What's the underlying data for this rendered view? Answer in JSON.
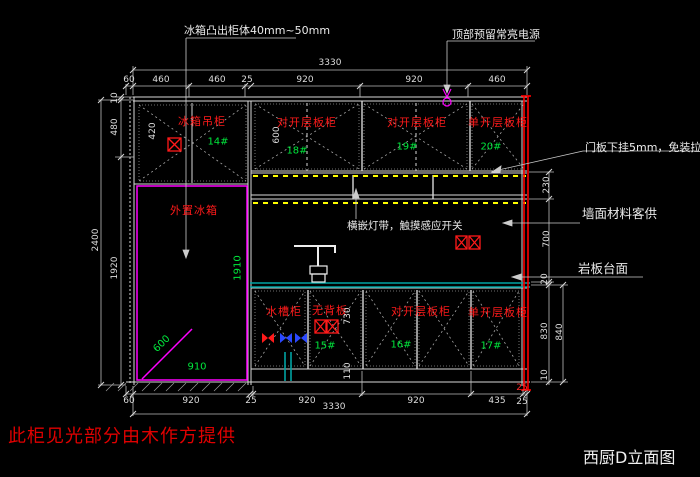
{
  "drawing": {
    "title": "西厨D立面图",
    "bottom_note": "此柜见光部分由木作方提供"
  },
  "annotations": {
    "fridge_protrusion": "冰箱凸出柜体40mm~50mm",
    "top_power": "顶部预留常亮电源",
    "door_gap": "门板下挂5mm，免装拉手",
    "wall_material": "墙面材料客供",
    "countertop": "岩板台面",
    "light_strip": "横嵌灯带，触摸感应开关"
  },
  "labels": {
    "fridge_cabinet": "冰箱吊柜",
    "fridge_cabinet_no": "14#",
    "upper_double_1": "对开层板柜",
    "upper_double_1_no": "18#",
    "upper_double_2": "对开层板柜",
    "upper_double_2_no": "19#",
    "upper_single": "单开层板柜",
    "upper_single_no": "20#",
    "sink_cabinet": "水槽柜",
    "no_back_panel": "无背板",
    "no_back_panel_no": "15#",
    "base_double": "对开层板柜",
    "base_double_no": "16#",
    "base_single": "单开层板柜",
    "base_single_no": "17#",
    "external_fridge": "外置冰箱"
  },
  "dims": {
    "top_total": "3330",
    "top_chain": [
      "60",
      "460",
      "460",
      "25",
      "920",
      "920",
      "460"
    ],
    "bottom_chain": [
      "60",
      "920",
      "25",
      "920",
      "920",
      "435"
    ],
    "bottom_wall": "25",
    "bottom_wall_red": "25",
    "bottom_total": "3330",
    "left_total": "2400",
    "left_chain": [
      "10",
      "480",
      "1920"
    ],
    "right_chain": [
      "230",
      "700",
      "20",
      "830",
      "10"
    ],
    "right_total": "840",
    "fridge_w": "910",
    "fridge_h": "1910",
    "fridge_diag": "600",
    "upper_h": "600",
    "fridge_cab_h": "420",
    "base_door_h": "730",
    "toe_kick": "110"
  },
  "colors": {
    "line": "#e0e0e0",
    "label_red": "#ff1a1a",
    "number_green": "#00e83c",
    "fridge_magenta": "#ff00ff",
    "counter_teal": "#00a3a3",
    "light_yellow": "#ffff00",
    "wall_red": "#ff0000"
  }
}
